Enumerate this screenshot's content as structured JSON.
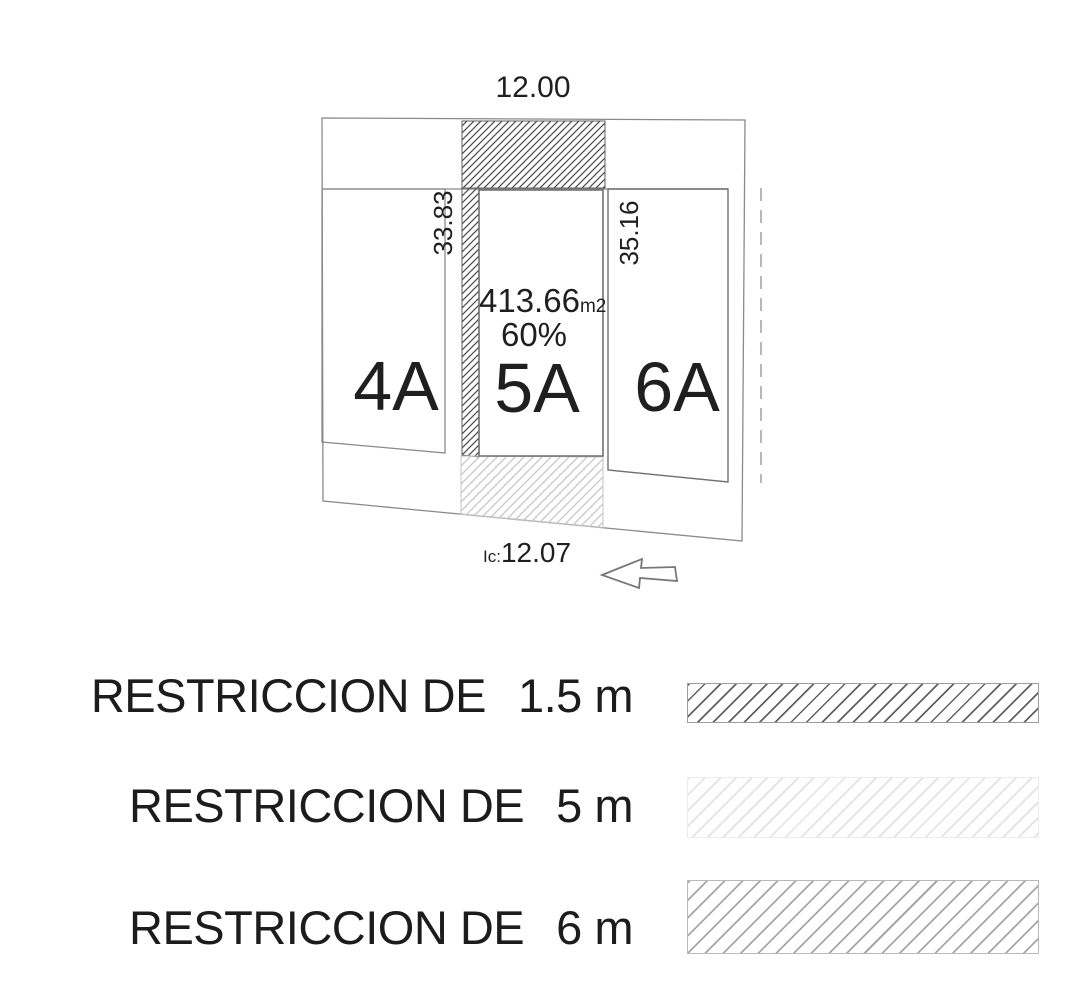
{
  "plan": {
    "dimensions": {
      "top_width": "12.00",
      "left_depth": "33.83",
      "right_depth": "35.16",
      "frontage_prefix": "Ic:",
      "frontage_value": "12.07"
    },
    "lots": [
      {
        "label": "4A"
      },
      {
        "label": "5A",
        "area": "413.66",
        "area_unit": "m2",
        "coverage": "60%"
      },
      {
        "label": "6A"
      }
    ]
  },
  "legend": {
    "items": [
      {
        "label": "RESTRICCION DE",
        "value": "1.5 m",
        "swatch": "dense-dark-hatch"
      },
      {
        "label": "RESTRICCION DE",
        "value": "5 m",
        "swatch": "faint-light-hatch"
      },
      {
        "label": "RESTRICCION DE",
        "value": "6 m",
        "swatch": "medium-gray-hatch"
      }
    ]
  },
  "colors": {
    "boundary_line": "#8a8a8a",
    "lot_line": "#6f6f6f",
    "text": "#1f1f1f",
    "muted_text": "#9a9a9a",
    "hatch_dark": "#4a4a4a",
    "hatch_light": "#c4c4c4",
    "legend_hatch_dark": "#606060",
    "legend_hatch_faint": "#e2e2e2",
    "legend_hatch_medium": "#a6a6a6"
  }
}
